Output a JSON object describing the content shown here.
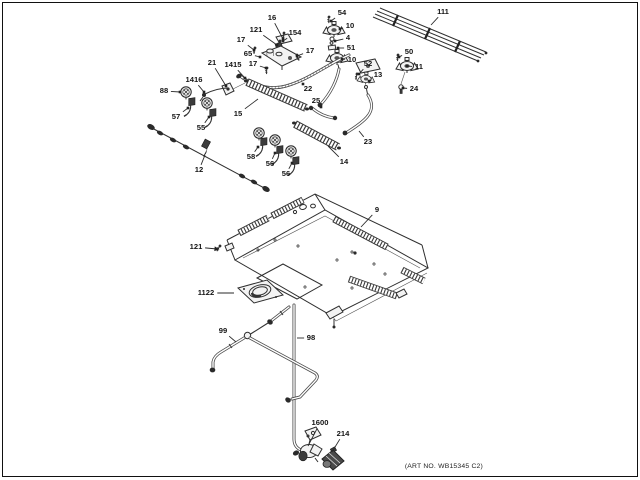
{
  "diagram": {
    "art_no": "(ART NO. WB15345 C2)",
    "label_color": "#141414",
    "line_color": "#2f2f2f",
    "labels": [
      {
        "text": "16",
        "x": 272,
        "y": 18,
        "tx": 283,
        "ty": 39
      },
      {
        "text": "121",
        "x": 256,
        "y": 30,
        "tx": 277,
        "ty": 45
      },
      {
        "text": "154",
        "x": 295,
        "y": 33,
        "tx": 283,
        "ty": 41
      },
      {
        "text": "17",
        "x": 241,
        "y": 40,
        "tx": 254,
        "ty": 50
      },
      {
        "text": "65",
        "x": 248,
        "y": 54,
        "tx": 260,
        "ty": 57
      },
      {
        "text": "17",
        "x": 310,
        "y": 51,
        "tx": 297,
        "ty": 56
      },
      {
        "text": "17",
        "x": 253,
        "y": 64,
        "tx": 266,
        "ty": 68
      },
      {
        "text": "21",
        "x": 212,
        "y": 63,
        "tx": 226,
        "ty": 86
      },
      {
        "text": "1415",
        "x": 233,
        "y": 65,
        "tx": 245,
        "ty": 78
      },
      {
        "text": "1416",
        "x": 194,
        "y": 80,
        "tx": 204,
        "ty": 92
      },
      {
        "text": "88",
        "x": 164,
        "y": 91,
        "tx": 180,
        "ty": 92
      },
      {
        "text": "57",
        "x": 176,
        "y": 117,
        "tx": 188,
        "ty": 108
      },
      {
        "text": "55",
        "x": 201,
        "y": 128,
        "tx": 209,
        "ty": 117
      },
      {
        "text": "15",
        "x": 238,
        "y": 114,
        "tx": 258,
        "ty": 99,
        "marker": "none"
      },
      {
        "text": "12",
        "x": 199,
        "y": 170,
        "tx": 205,
        "ty": 155,
        "marker": "none"
      },
      {
        "text": "58",
        "x": 251,
        "y": 157,
        "tx": 258,
        "ty": 147
      },
      {
        "text": "56",
        "x": 270,
        "y": 164,
        "tx": 275,
        "ty": 153
      },
      {
        "text": "56",
        "x": 286,
        "y": 174,
        "tx": 292,
        "ty": 163
      },
      {
        "text": "54",
        "x": 342,
        "y": 13,
        "tx": 331,
        "ty": 21
      },
      {
        "text": "10",
        "x": 350,
        "y": 26,
        "tx": 340,
        "ty": 29
      },
      {
        "text": "4",
        "x": 348,
        "y": 38,
        "tx": 335,
        "ty": 41
      },
      {
        "text": "51",
        "x": 351,
        "y": 48,
        "tx": 338,
        "ty": 48
      },
      {
        "text": "10",
        "x": 352,
        "y": 60,
        "tx": 342,
        "ty": 59
      },
      {
        "text": "52",
        "x": 368,
        "y": 64,
        "tx": 359,
        "ty": 74
      },
      {
        "text": "13",
        "x": 378,
        "y": 75,
        "tx": 369,
        "ty": 81
      },
      {
        "text": "50",
        "x": 409,
        "y": 52,
        "tx": 399,
        "ty": 57
      },
      {
        "text": "11",
        "x": 419,
        "y": 67,
        "tx": 407,
        "ty": 66
      },
      {
        "text": "24",
        "x": 414,
        "y": 89,
        "tx": 403,
        "ty": 88
      },
      {
        "text": "111",
        "x": 443,
        "y": 12,
        "tx": 431,
        "ty": 25,
        "marker": "none"
      },
      {
        "text": "22",
        "x": 308,
        "y": 89,
        "tx": 303,
        "ty": 84
      },
      {
        "text": "25",
        "x": 316,
        "y": 101,
        "tx": 321,
        "ty": 107
      },
      {
        "text": "23",
        "x": 368,
        "y": 142,
        "tx": 359,
        "ty": 131,
        "marker": "none"
      },
      {
        "text": "14",
        "x": 344,
        "y": 162,
        "tx": 328,
        "ty": 146,
        "marker": "none"
      },
      {
        "text": "9",
        "x": 377,
        "y": 210,
        "tx": 361,
        "ty": 227,
        "marker": "none"
      },
      {
        "text": "121",
        "x": 196,
        "y": 247,
        "tx": 217,
        "ty": 249,
        "marker": "arrow"
      },
      {
        "text": "1122",
        "x": 206,
        "y": 293,
        "tx": 234,
        "ty": 293,
        "marker": "none"
      },
      {
        "text": "99",
        "x": 223,
        "y": 331,
        "tx": 236,
        "ty": 342,
        "marker": "none"
      },
      {
        "text": "98",
        "x": 311,
        "y": 338,
        "tx": 297,
        "ty": 338,
        "marker": "none"
      },
      {
        "text": "1600",
        "x": 320,
        "y": 423,
        "tx": 308,
        "ty": 446,
        "marker": "none"
      },
      {
        "text": "214",
        "x": 343,
        "y": 434,
        "tx": 332,
        "ty": 452,
        "marker": "none"
      }
    ]
  }
}
